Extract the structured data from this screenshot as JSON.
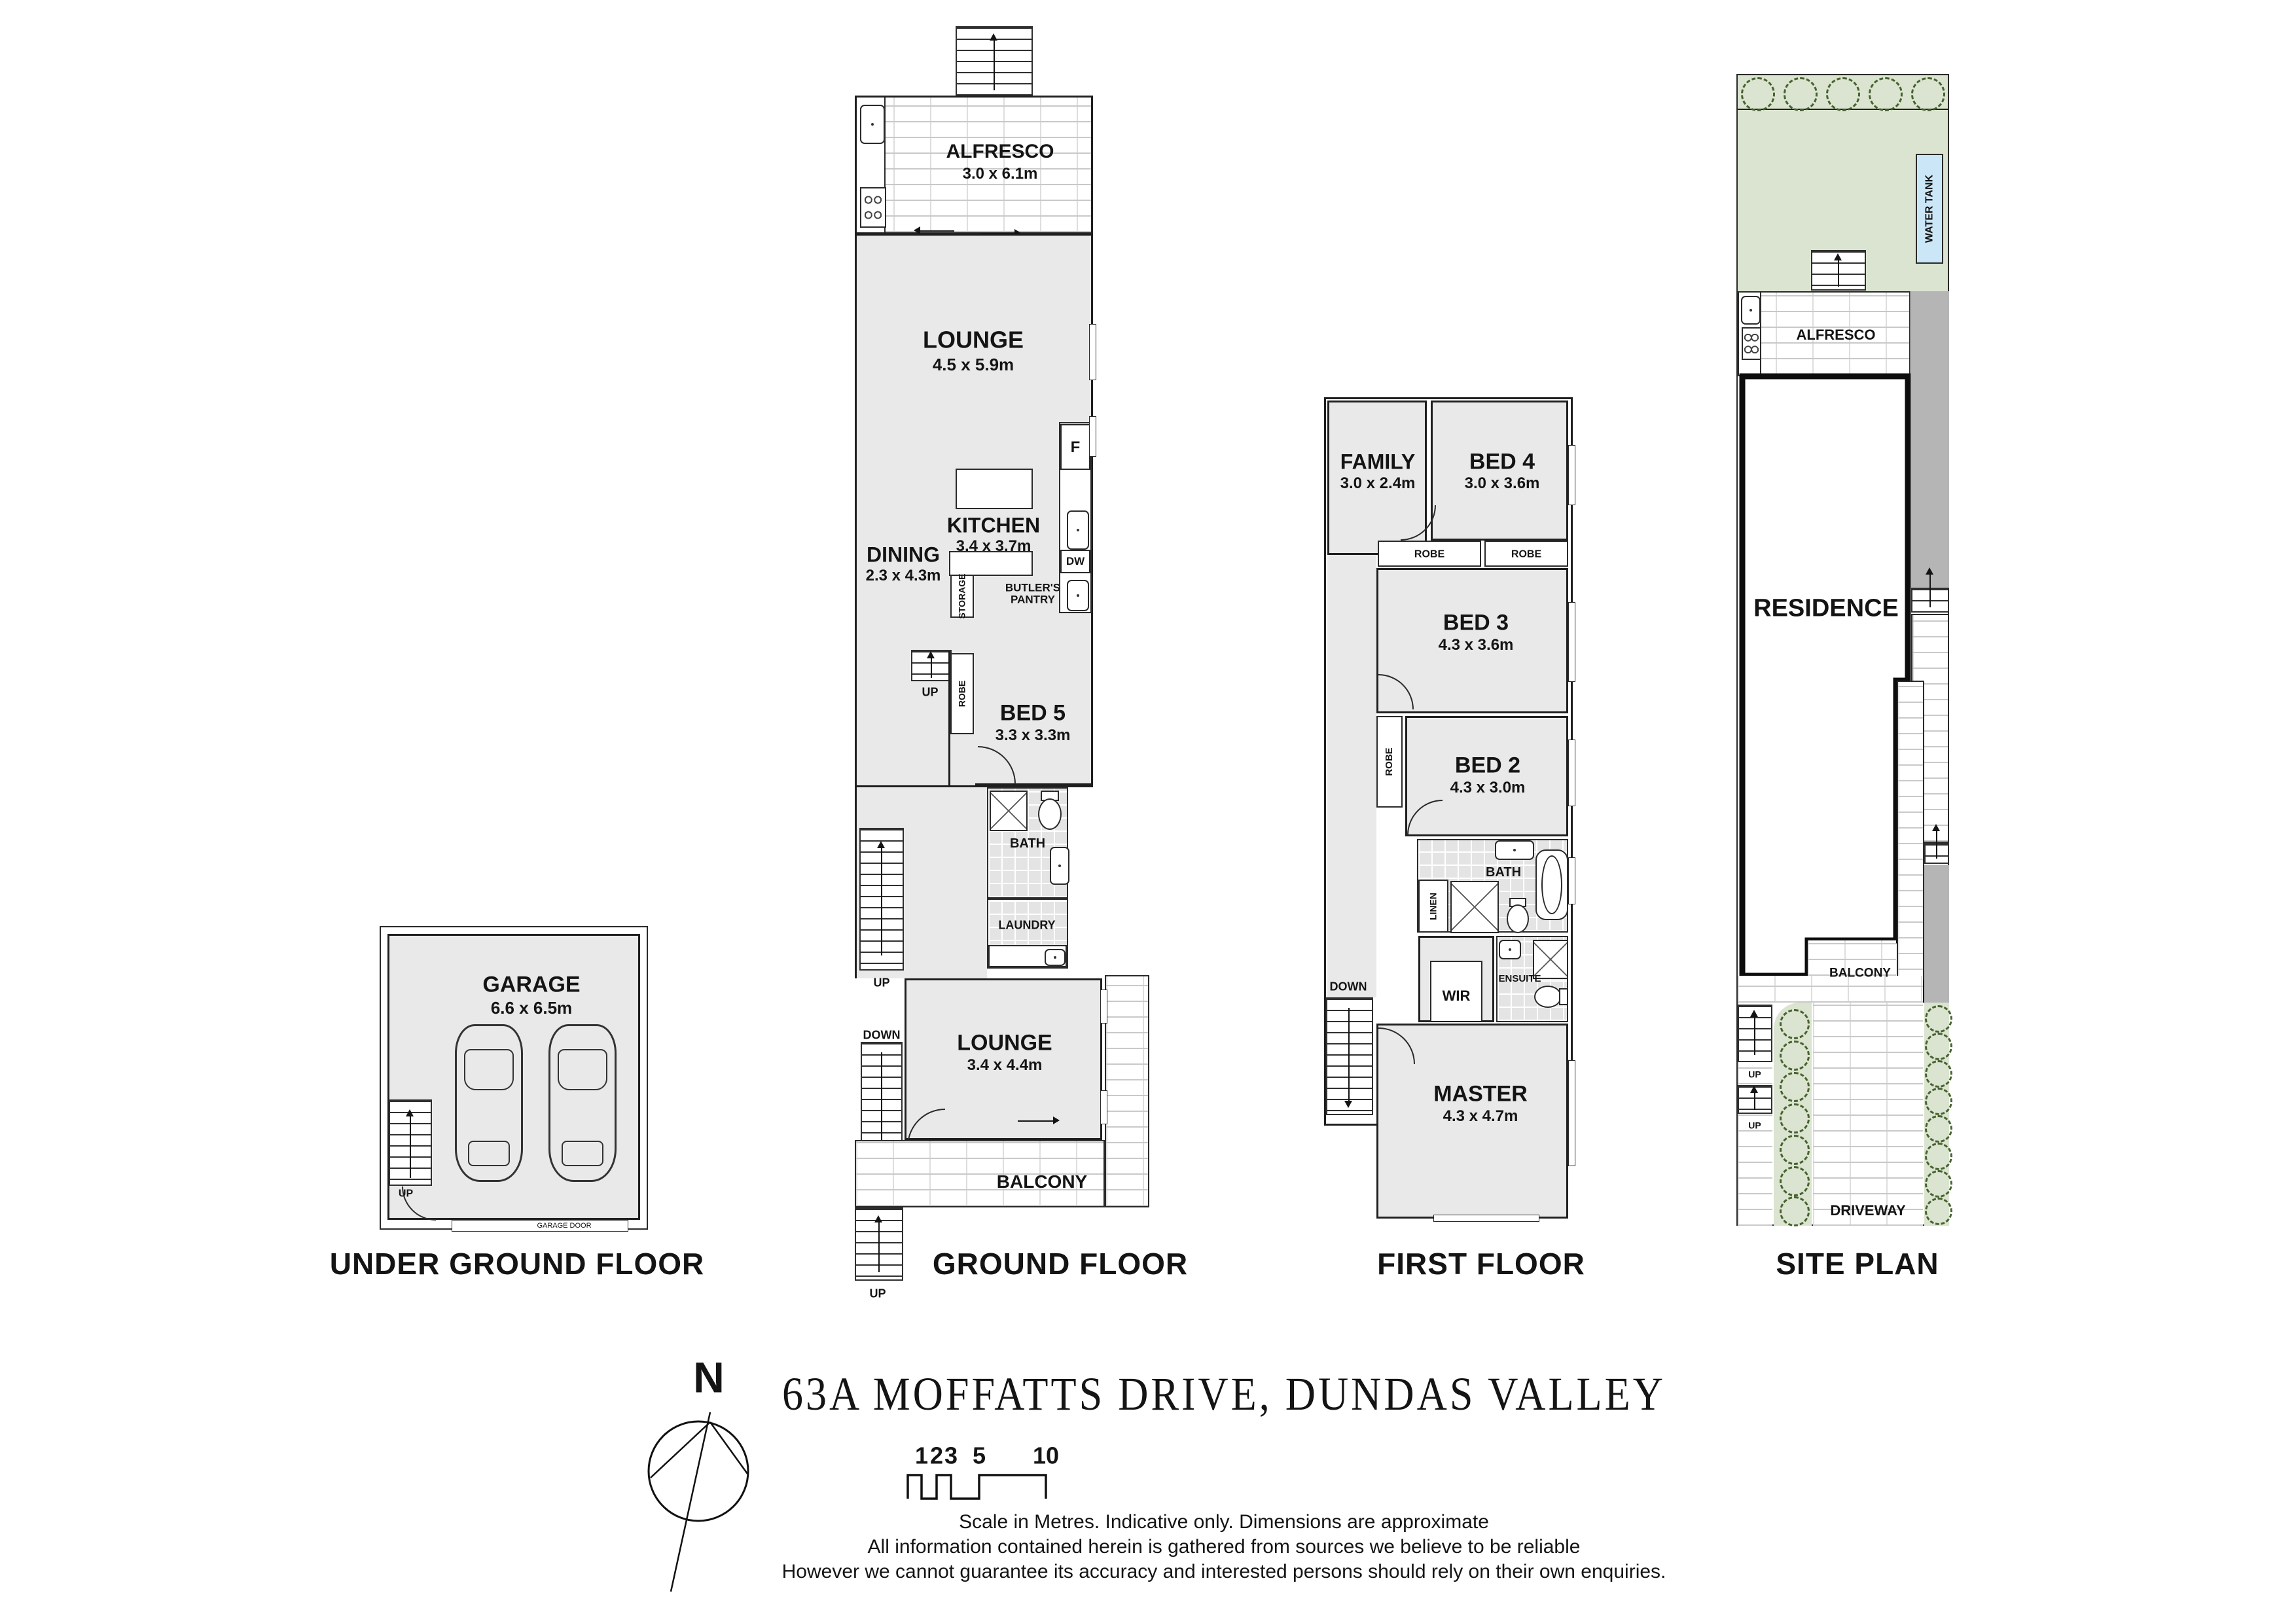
{
  "title": "63A MOFFATTS DRIVE, DUNDAS VALLEY",
  "compass": {
    "north": "N"
  },
  "scale_bar": {
    "ticks": [
      "1",
      "2",
      "3",
      "5",
      "10"
    ]
  },
  "disclaimer": {
    "line1": "Scale in Metres. Indicative only. Dimensions are approximate",
    "line2": "All information contained herein is gathered from sources we believe to be reliable",
    "line3": "However we cannot guarantee its accuracy and interested persons should rely on their own enquiries."
  },
  "labels": {
    "up": "UP",
    "down": "DOWN",
    "entry": "ENTRY",
    "robe": "ROBE",
    "storage": "STORAGE",
    "bath": "BATH",
    "laundry": "LAUNDRY",
    "linen": "LINEN",
    "wir": "WIR",
    "ensuite": "ENSUITE",
    "balcony": "BALCONY",
    "fridge": "F",
    "dishwasher": "DW",
    "butlers_pantry": "BUTLER'S PANTRY",
    "garage_door": "GARAGE DOOR",
    "water_tank": "WATER TANK",
    "driveway": "DRIVEWAY",
    "residence": "RESIDENCE",
    "alfresco": "ALFRESCO"
  },
  "floors": {
    "underground": {
      "title": "UNDER GROUND FLOOR",
      "rooms": {
        "garage": {
          "name": "GARAGE",
          "dims": "6.6 x 6.5m"
        }
      }
    },
    "ground": {
      "title": "GROUND FLOOR",
      "rooms": {
        "alfresco": {
          "name": "ALFRESCO",
          "dims": "3.0 x 6.1m"
        },
        "lounge": {
          "name": "LOUNGE",
          "dims": "4.5 x 5.9m"
        },
        "kitchen": {
          "name": "KITCHEN",
          "dims": "3.4 x 3.7m"
        },
        "dining": {
          "name": "DINING",
          "dims": "2.3 x 4.3m"
        },
        "bed5": {
          "name": "BED 5",
          "dims": "3.3 x 3.3m"
        },
        "lounge2": {
          "name": "LOUNGE",
          "dims": "3.4 x 4.4m"
        }
      }
    },
    "first": {
      "title": "FIRST FLOOR",
      "rooms": {
        "family": {
          "name": "FAMILY",
          "dims": "3.0 x 2.4m"
        },
        "bed4": {
          "name": "BED 4",
          "dims": "3.0 x 3.6m"
        },
        "bed3": {
          "name": "BED 3",
          "dims": "4.3 x 3.6m"
        },
        "bed2": {
          "name": "BED 2",
          "dims": "4.3 x 3.0m"
        },
        "master": {
          "name": "MASTER",
          "dims": "4.3 x 4.7m"
        }
      }
    },
    "site": {
      "title": "SITE PLAN"
    }
  },
  "colors": {
    "room_fill": "#e9e9e9",
    "site_green": "#dbe4d0",
    "water_tank_blue": "#cae6f7",
    "path_grey": "#b5b5b5"
  }
}
